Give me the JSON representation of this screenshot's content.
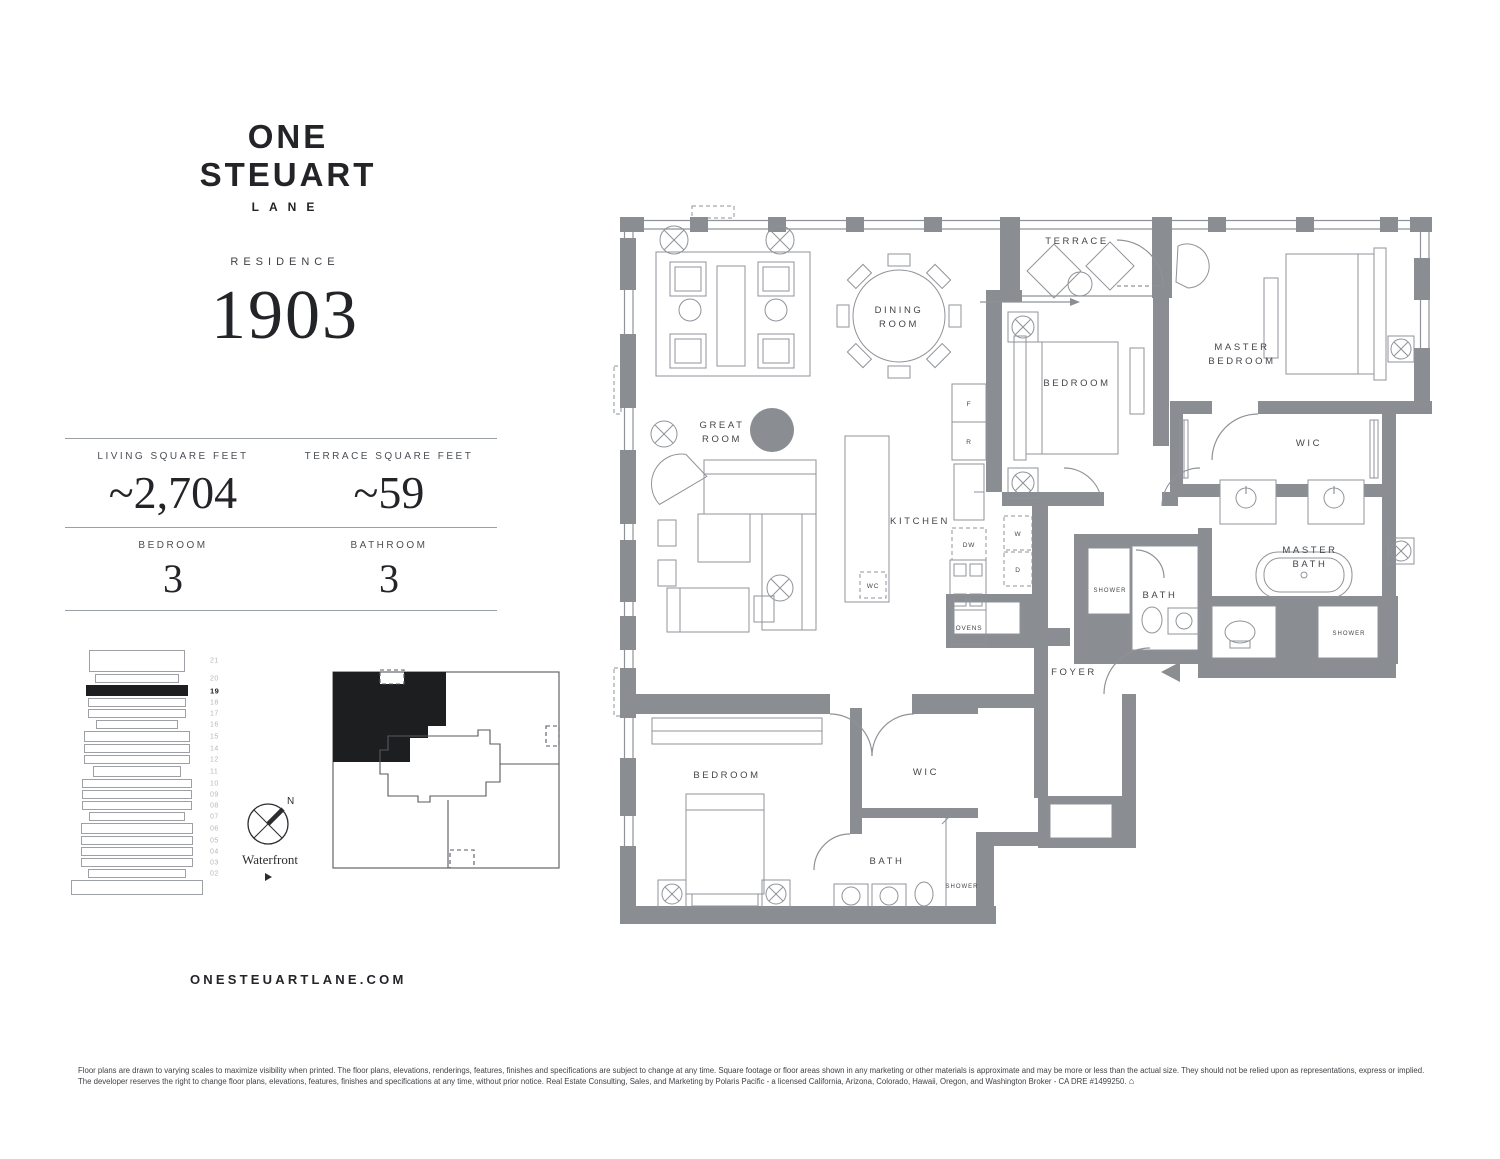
{
  "colors": {
    "wall_gray": "#8a8e93",
    "ink": "#232428"
  },
  "brand": {
    "title": "ONE STEUART",
    "subtitle": "LANE",
    "website": "ONESTEUARTLANE.COM"
  },
  "residence": {
    "label": "RESIDENCE",
    "number": "1903"
  },
  "stats": {
    "living_label": "LIVING SQUARE FEET",
    "living_value": "~2,704",
    "terrace_label": "TERRACE SQUARE FEET",
    "terrace_value": "~59",
    "bedroom_label": "BEDROOM",
    "bedroom_value": "3",
    "bathroom_label": "BATHROOM",
    "bathroom_value": "3"
  },
  "building_stack": {
    "floors": [
      "21",
      "20",
      "19",
      "18",
      "17",
      "16",
      "15",
      "14",
      "12",
      "11",
      "10",
      "09",
      "08",
      "07",
      "06",
      "05",
      "04",
      "03",
      "02"
    ],
    "highlighted_floor": "19"
  },
  "compass": {
    "north": "N",
    "waterfront": "Waterfront"
  },
  "plan": {
    "terrace": "TERRACE",
    "dining_l1": "DINING",
    "dining_l2": "ROOM",
    "great_l1": "GREAT",
    "great_l2": "ROOM",
    "master_bedroom_l1": "MASTER",
    "master_bedroom_l2": "BEDROOM",
    "bedroom_mid": "BEDROOM",
    "kitchen": "KITCHEN",
    "wic_master": "WIC",
    "master_bath_l1": "MASTER",
    "master_bath_l2": "BATH",
    "shower_master": "SHOWER",
    "bath_mid": "BATH",
    "shower_mid": "SHOWER",
    "foyer": "FOYER",
    "bedroom_wing": "BEDROOM",
    "wic_wing": "WIC",
    "bath_wing": "BATH",
    "shower_wing": "SHOWER",
    "appl_f": "F",
    "appl_r": "R",
    "appl_dw": "DW",
    "appl_ovens": "OVENS",
    "appl_w": "W",
    "appl_d": "D",
    "appl_wc": "WC"
  },
  "footer": {
    "disclaimer": "Floor plans are drawn to varying scales to maximize visibility when printed. The floor plans, elevations, renderings, features, finishes and specifications are subject to change at any time. Square footage or floor areas shown in any marketing or other materials is approximate and may be more or less than the actual size. They should not be relied upon as representations, express or implied. The developer reserves the right to change floor plans, elevations, features, finishes and specifications at any time, without prior notice. Real Estate Consulting, Sales, and Marketing by Polaris Pacific - a licensed California, Arizona, Colorado, Hawaii, Oregon, and Washington Broker - CA DRE #1499250."
  }
}
